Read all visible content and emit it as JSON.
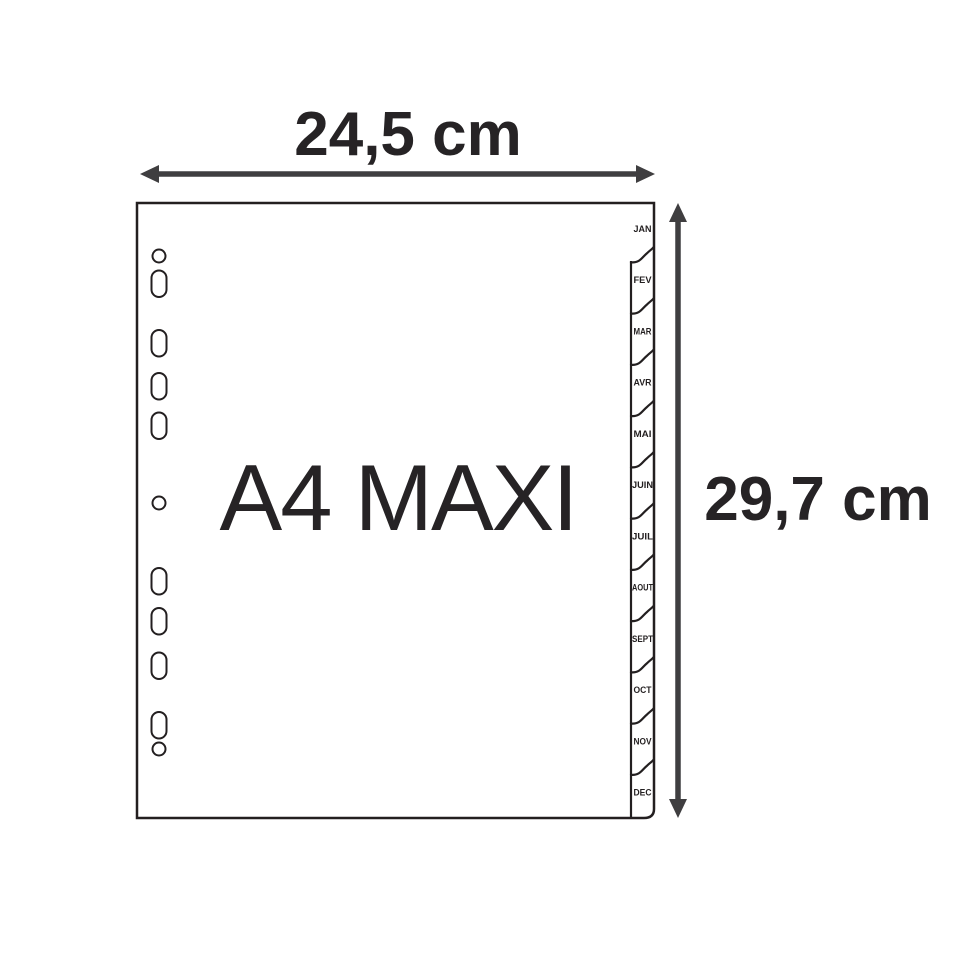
{
  "figure": {
    "title": "A4 MAXI",
    "width_dimension": "24,5 cm",
    "height_dimension": "29,7 cm",
    "tabs": [
      "JAN",
      "FEV",
      "MAR",
      "AVR",
      "MAI",
      "JUIN",
      "JUIL",
      "AOUT",
      "SEPT",
      "OCT",
      "NOV",
      "DEC"
    ]
  },
  "colors": {
    "background": "#ffffff",
    "outline": "#231f20",
    "arrow": "#3f3e40",
    "text": "#262325"
  }
}
